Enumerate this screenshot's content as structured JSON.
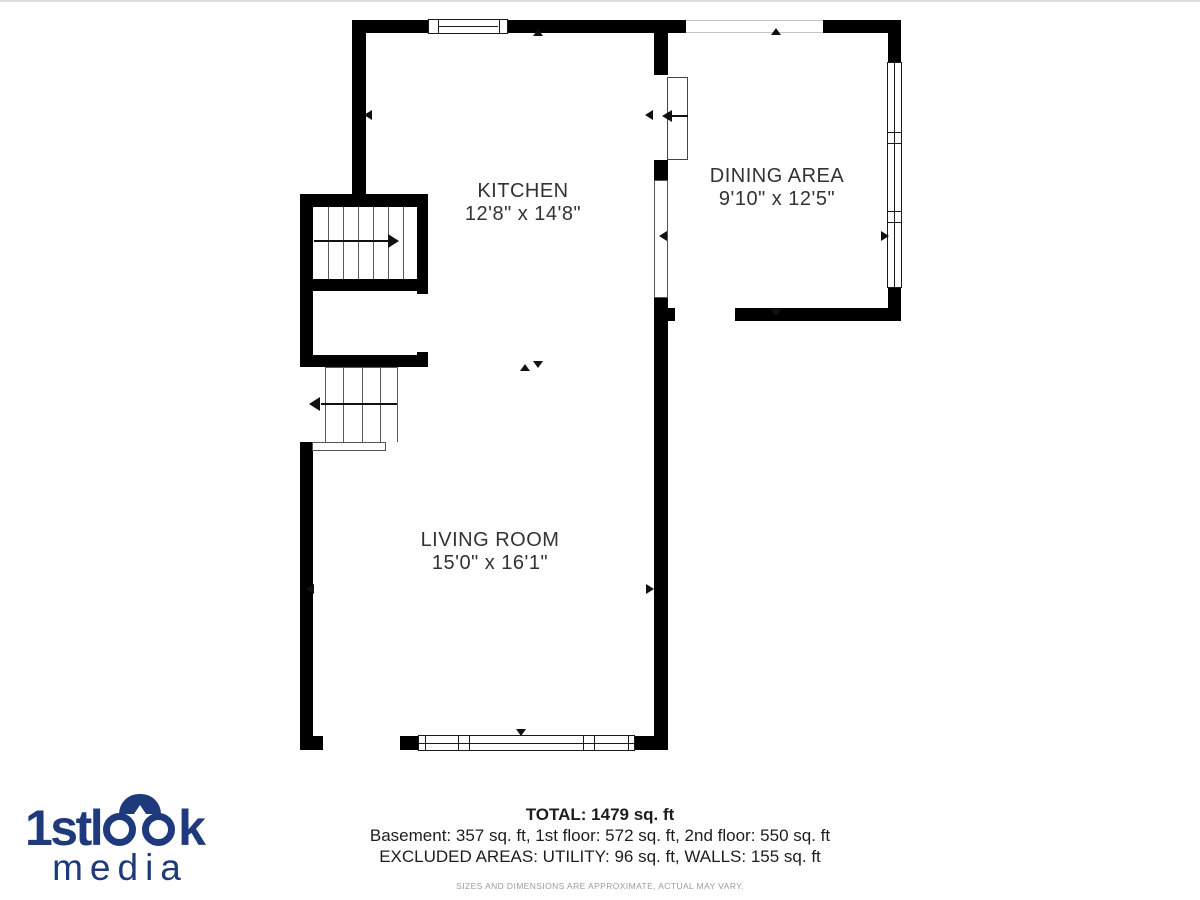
{
  "floor_plan": {
    "wall_color": "#000000",
    "label_color": "#333333",
    "rooms": [
      {
        "id": "kitchen",
        "name": "KITCHEN",
        "dimensions": "12'8\" x 14'8\""
      },
      {
        "id": "dining",
        "name": "DINING AREA",
        "dimensions": "9'10\" x 12'5\""
      },
      {
        "id": "living",
        "name": "LIVING ROOM",
        "dimensions": "15'0\" x 16'1\""
      }
    ],
    "features": [
      "staircase-up",
      "staircase-down",
      "door-swing",
      "windows",
      "opening-markers"
    ]
  },
  "summary": {
    "total": "TOTAL: 1479 sq. ft",
    "floor_breakdown": "Basement: 357 sq. ft, 1st floor: 572 sq. ft, 2nd floor: 550 sq. ft",
    "excluded_areas": "EXCLUDED AREAS: UTILITY: 96 sq. ft, WALLS: 155 sq. ft",
    "disclaimer": "SIZES AND DIMENSIONS ARE APPROXIMATE, ACTUAL MAY VARY."
  },
  "logo": {
    "brand_full": "1stlook",
    "brand_prefix": "1stl",
    "brand_suffix": "k",
    "subbrand": "media",
    "color": "#1e3a7c"
  }
}
